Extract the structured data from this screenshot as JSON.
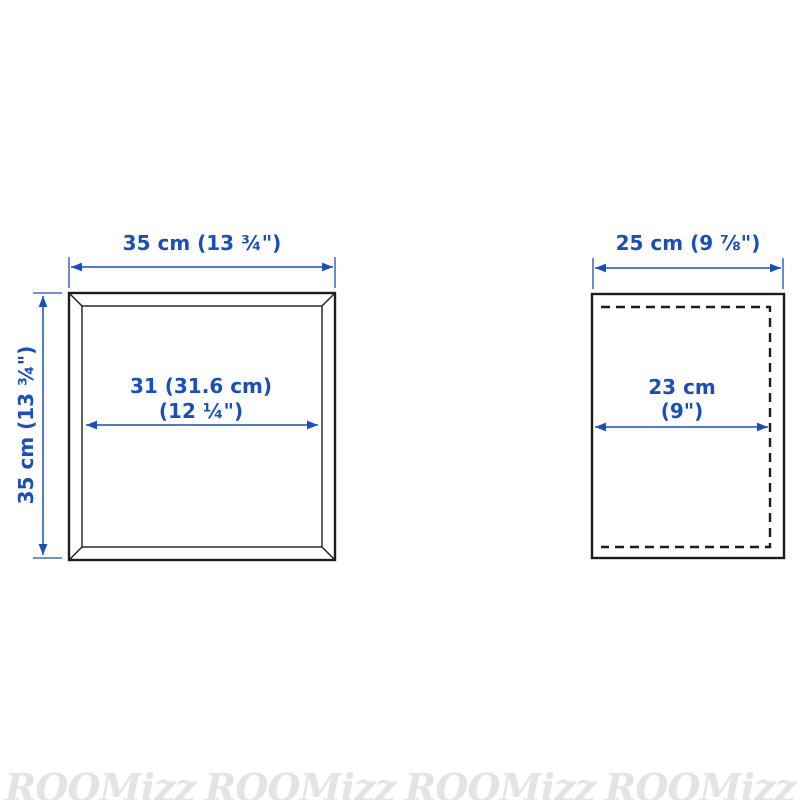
{
  "colors": {
    "dimension_blue": "#1b4fb8",
    "outline_black": "#1c1c1c",
    "watermark_gray": "#e4e4e4",
    "background": "#ffffff"
  },
  "front_view": {
    "width_label": "35 cm (13 ¾\")",
    "height_label": "35 cm (13 ¾\")",
    "inner_width_label_line1": "31 (31.6 cm)",
    "inner_width_label_line2": "(12 ¼\")"
  },
  "side_view": {
    "depth_label": "25 cm (9 ⅞\")",
    "inner_depth_label_line1": "23 cm",
    "inner_depth_label_line2": "(9\")"
  },
  "watermark": {
    "text": "ROOMizz",
    "count": 4
  }
}
